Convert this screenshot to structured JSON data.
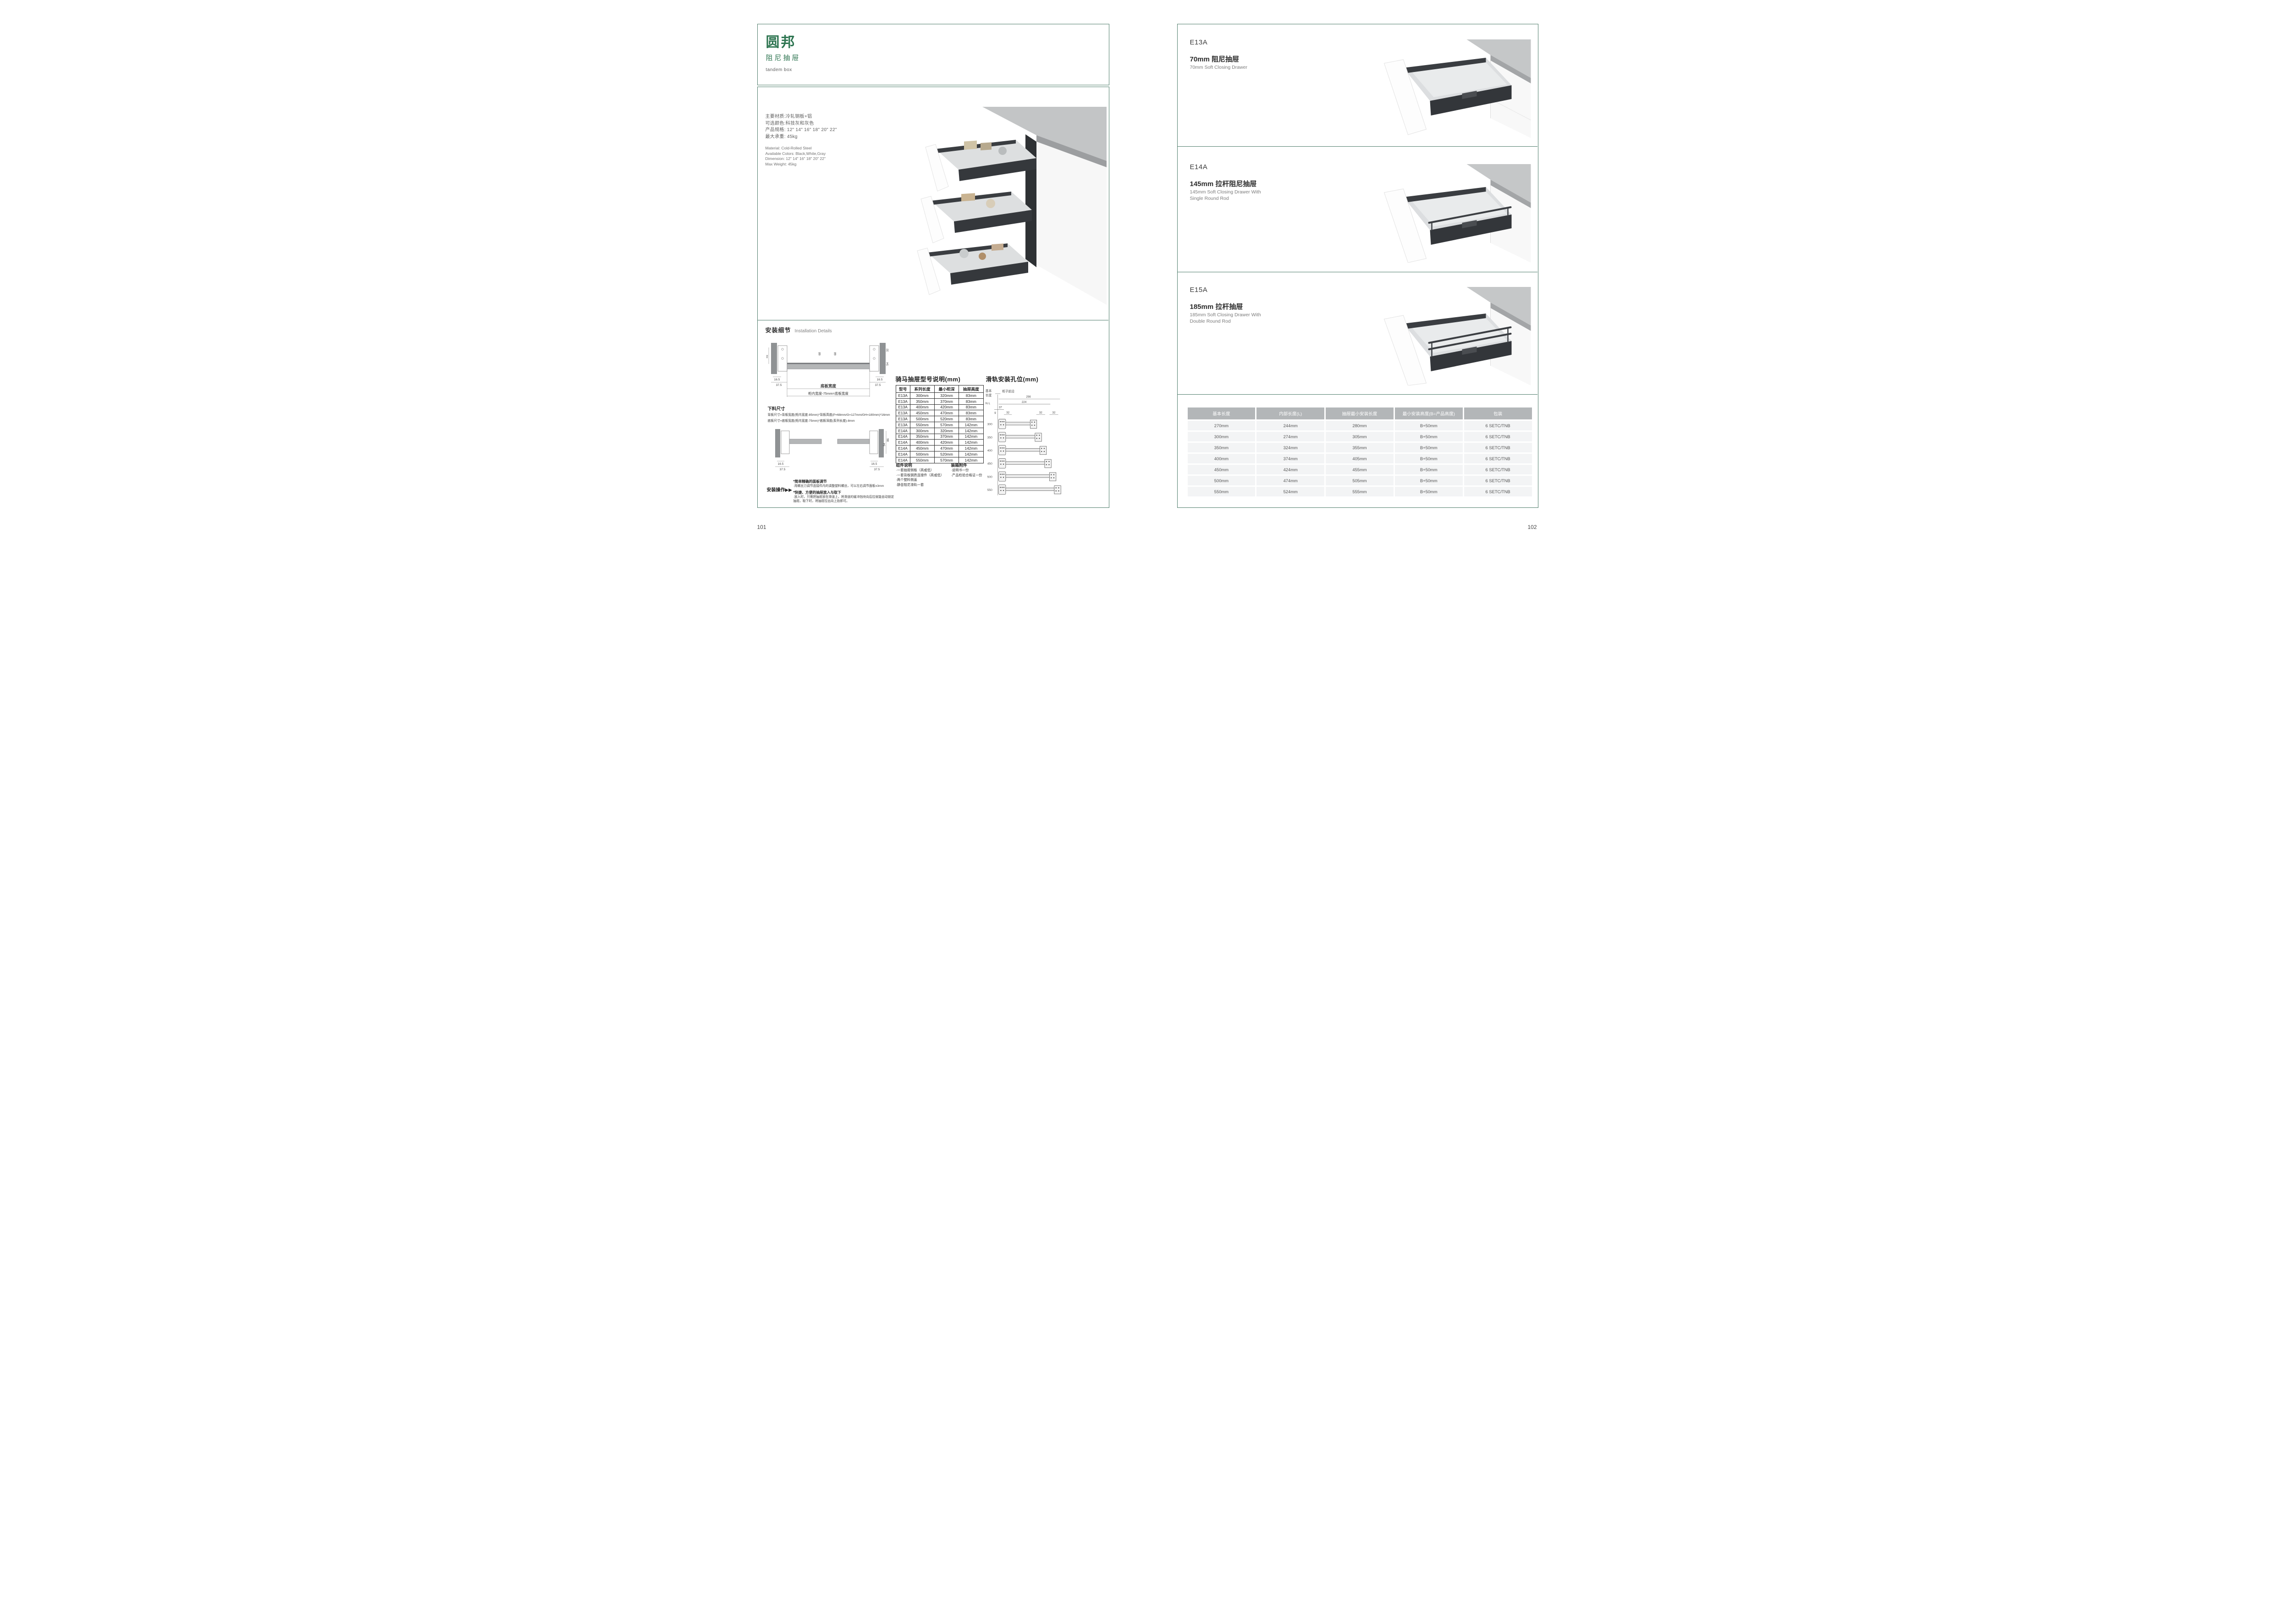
{
  "colors": {
    "brand_green": "#2e7551",
    "frame_teal": "#4f7d6b",
    "table_header_gray": "#b3b6b8",
    "table_row_gray": "#f3f4f5"
  },
  "page_left": {
    "page_number": "101",
    "logo": {
      "brand": "圆邦",
      "subtitle": "阻尼抽屉",
      "tagline": "tandem box"
    },
    "specs_cn": [
      "主要材质:冷轧钢板+铝",
      "可选颜色:科技灰和灰色",
      "产品规格: 12\" 14\" 16\" 18\" 20\" 22\"",
      "最大承重: 45kg"
    ],
    "specs_en": [
      "Material: Cold-Rolled Steel",
      "Available Colors: Black,White,Gray",
      "Dimension: 12\" 14\" 16\" 18\" 20\" 22\"",
      "Max Weight: 45kg"
    ],
    "install": {
      "title_cn": "安装细节",
      "title_en": "Installation Details",
      "width_diagram": {
        "caption1": "底板宽度",
        "caption2": "柜内宽度-75mm=底板宽度",
        "dims": {
          "h46": "46",
          "l165": "16.5",
          "l375": "37.5",
          "m68a": "68",
          "m68b": "68",
          "r32": "32",
          "r54": "54",
          "r165": "16.5",
          "r375": "37.5"
        }
      },
      "cutting": {
        "title": "下料尺寸",
        "lines": [
          "背板尺寸=背板宽度(柜内宽度-85mm)*背板高度(P=68mm/G=127mm/GH=180mm)*16mm",
          "底板尺寸=底板宽度(柜内宽度-75mm)*底板深度(系列长度)-8mm"
        ]
      },
      "side_diagram": {
        "dims": {
          "a165": "16.5",
          "a375": "37.5",
          "b165": "16.5",
          "b375": "37.5",
          "v54": "54",
          "v86": "86"
        }
      },
      "operation": {
        "title": "安装操作▶▶",
        "items": [
          {
            "head": "*简单精确的面板调节",
            "body": "·用螺丝刀调节连接件内的调整塑料螺丝，可以左右调节面板±3mm"
          },
          {
            "head": "*快捷、方便的抽屉放入与取下",
            "body": "·放入时，只需把抽屉放在滑道上，将滑道的缓冲挡块向后拉就能自动锁定抽屉。取下时，将抽屉拉出向上抬即可。"
          }
        ]
      },
      "model_table": {
        "title": "骑马抽屉型号说明(mm)",
        "headers": [
          "型号",
          "系列长度",
          "最小柜深",
          "抽屉高度"
        ],
        "rows": [
          [
            "E13A",
            "300mm",
            "320mm",
            "83mm"
          ],
          [
            "E13A",
            "350mm",
            "370mm",
            "83mm"
          ],
          [
            "E13A",
            "400mm",
            "420mm",
            "83mm"
          ],
          [
            "E13A",
            "450mm",
            "470mm",
            "83mm"
          ],
          [
            "E13A",
            "500mm",
            "520mm",
            "83mm"
          ],
          [
            "E13A",
            "550mm",
            "570mm",
            "142mm"
          ],
          [
            "E14A",
            "300mm",
            "320mm",
            "142mm"
          ],
          [
            "E14A",
            "350mm",
            "370mm",
            "142mm"
          ],
          [
            "E14A",
            "400mm",
            "420mm",
            "142mm"
          ],
          [
            "E14A",
            "450mm",
            "470mm",
            "142mm"
          ],
          [
            "E14A",
            "500mm",
            "520mm",
            "142mm"
          ],
          [
            "E14A",
            "550mm",
            "570mm",
            "142mm"
          ]
        ]
      },
      "component_notes": {
        "title": "组件说明",
        "items": [
          "·一套抽屉侧板（高或低）",
          "·一套背板钢质连接件（高或低）",
          "·两个塑料侧盖",
          "·静音阻尼滑轨一套"
        ]
      },
      "packing_notes": {
        "title": "装箱附件",
        "items": [
          "·说明书一份",
          "·产品检验合格证一份"
        ]
      },
      "rail_diagram": {
        "title": "滑轨安装孔位(mm)",
        "labels": {
          "basic1": "基本",
          "basic2": "长度",
          "nl": "N L",
          "front": "柜子前沿"
        },
        "dims": {
          "d256": "256",
          "d224": "224",
          "d37": "37",
          "d9": "9",
          "d32a": "32",
          "d32b": "32",
          "d32c": "32"
        },
        "lengths": [
          "300",
          "350",
          "400",
          "450",
          "500",
          "550"
        ]
      }
    }
  },
  "page_right": {
    "page_number": "102",
    "products": [
      {
        "code": "E13A",
        "name_cn": "70mm 阻尼抽屉",
        "name_en": "70mm Soft Closing Drawer"
      },
      {
        "code": "E14A",
        "name_cn": "145mm 拉杆阻尼抽屉",
        "name_en": "145mm Soft Closing Drawer With Single Round Rod"
      },
      {
        "code": "E15A",
        "name_cn": "185mm 拉杆抽屉",
        "name_en": "185mm Soft Closing Drawer With Double Round Rod"
      }
    ],
    "size_table": {
      "headers": [
        "基本长度",
        "内部长度(L)",
        "抽屉最小安装长度",
        "最小安装高度(B=产品高度)",
        "包装"
      ],
      "rows": [
        [
          "270mm",
          "244mm",
          "280mm",
          "B+50mm",
          "6 SETC/TNB"
        ],
        [
          "300mm",
          "274mm",
          "305mm",
          "B+50mm",
          "6 SETC/TNB"
        ],
        [
          "350mm",
          "324mm",
          "355mm",
          "B+50mm",
          "6 SETC/TNB"
        ],
        [
          "400mm",
          "374mm",
          "405mm",
          "B+50mm",
          "6 SETC/TNB"
        ],
        [
          "450mm",
          "424mm",
          "455mm",
          "B+50mm",
          "6 SETC/TNB"
        ],
        [
          "500mm",
          "474mm",
          "505mm",
          "B+50mm",
          "6 SETC/TNB"
        ],
        [
          "550mm",
          "524mm",
          "555mm",
          "B+50mm",
          "6 SETC/TNB"
        ]
      ]
    }
  }
}
